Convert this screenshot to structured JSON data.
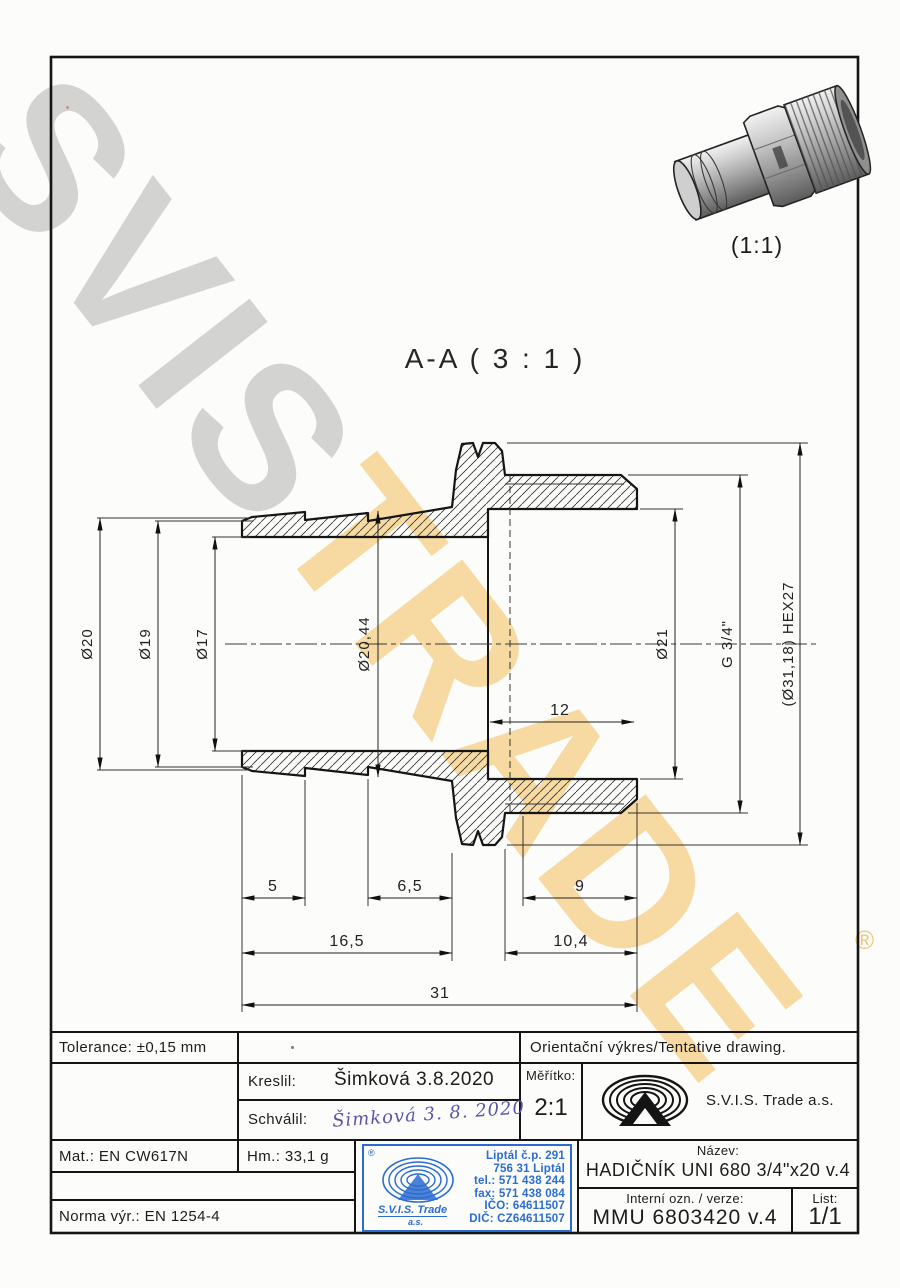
{
  "watermark": {
    "word1": "SVIS",
    "word2": "TRADE",
    "registered": "®"
  },
  "photo": {
    "scale": "(1:1)"
  },
  "drawing": {
    "section_label": "A-A ( 3 : 1 )",
    "dims": {
      "d20": "Ø20",
      "d19": "Ø19",
      "d17": "Ø17",
      "d20_44": "Ø20,44",
      "d21": "Ø21",
      "g34": "G 3/4\"",
      "hex": "(Ø31,18) HEX27",
      "len5": "5",
      "len6_5": "6,5",
      "len9": "9",
      "len16_5": "16,5",
      "len10_4": "10,4",
      "len31": "31",
      "len12": "12"
    }
  },
  "titleblock": {
    "tolerance": "Tolerance: ±0,15 mm",
    "kreslil_label": "Kreslil:",
    "kreslil_value": "Šimková 3.8.2020",
    "schvalil_label": "Schválil:",
    "schvalil_value": "Šimková  3. 8. 2020",
    "orientacni": "Orientační výkres/Tentative drawing.",
    "meritko_label": "Měřítko:",
    "meritko_value": "2:1",
    "company": "S.V.I.S. Trade a.s.",
    "mat": "Mat.: EN CW617N",
    "hm": "Hm.: 33,1 g",
    "norma": "Norma výr.: EN 1254-4",
    "nazev_label": "Název:",
    "nazev_value": "HADIČNÍK UNI 680 3/4\"x20 v.4",
    "interni_label": "Interní ozn. / verze:",
    "interni_value": "MMU 6803420 v.4",
    "list_label": "List:",
    "list_value": "1/1"
  },
  "stamp": {
    "registered": "®",
    "company": "S.V.I.S. Trade",
    "company2": "a.s.",
    "lines": [
      "Liptál č.p. 291",
      "756 31 Liptál",
      "tel.: 571 438 244",
      "fax: 571 438 084",
      "IČO: 64611507",
      "DIČ: CZ64611507"
    ]
  },
  "colors": {
    "stamp_blue": "#2a6cd0",
    "signature_ink": "#5c55aa",
    "watermark_gray": "#aaaaaa",
    "watermark_orange": "#f3c46b",
    "line_black": "#1c1c1c"
  }
}
